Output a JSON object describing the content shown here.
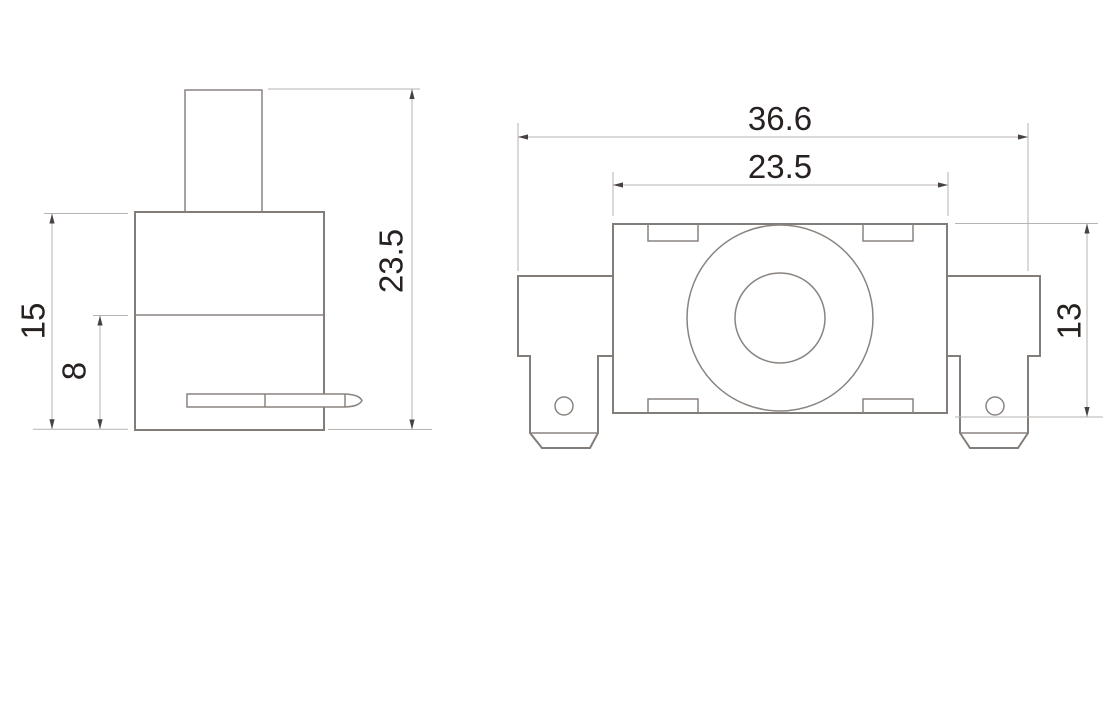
{
  "drawing": {
    "type": "technical-drawing",
    "views": {
      "side_view": {
        "name": "side-view",
        "dims": {
          "body_height": "15",
          "lower_section": "8",
          "full_height": "23.5"
        }
      },
      "front_view": {
        "name": "front-view",
        "dims": {
          "overall_width": "36.6",
          "body_width": "23.5",
          "body_height": "13"
        }
      }
    },
    "colors": {
      "background": "#ffffff",
      "outline": "#837d79",
      "dimension_line": "#b6b3b0",
      "arrow": "#474240",
      "text": "#272120"
    }
  }
}
